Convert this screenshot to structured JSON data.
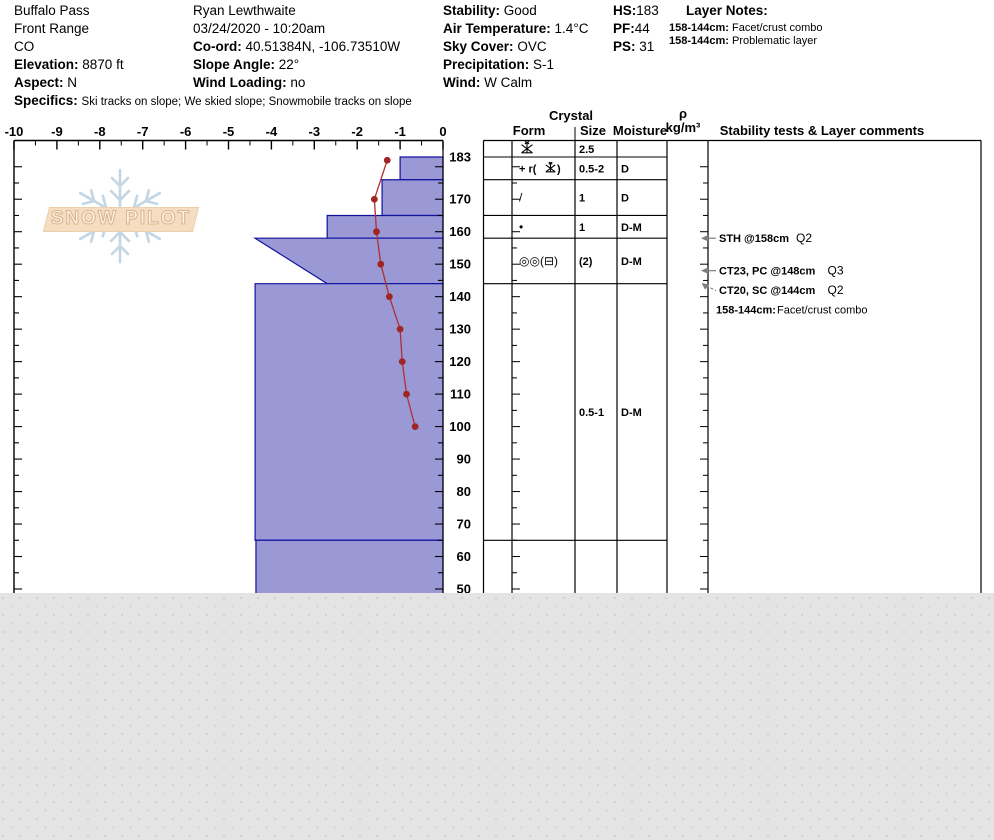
{
  "header": {
    "location": {
      "line1": "Buffalo Pass",
      "line2": "Front Range",
      "line3": "CO",
      "elevation_label": "Elevation:",
      "elevation": "8870 ft",
      "aspect_label": "Aspect:",
      "aspect": "N",
      "specifics_label": "Specifics:",
      "specifics": "Ski tracks on slope; We skied slope; Snowmobile tracks on slope"
    },
    "observer": {
      "name": "Ryan Lewthwaite",
      "datetime": "03/24/2020 - 10:20am",
      "coord_label": "Co-ord:",
      "coord": "40.51384N, -106.73510W",
      "slope_angle_label": "Slope Angle:",
      "slope_angle": "22°",
      "wind_loading_label": "Wind Loading:",
      "wind_loading": "no"
    },
    "conditions": {
      "stability_label": "Stability:",
      "stability": "Good",
      "air_temp_label": "Air Temperature:",
      "air_temp": "1.4°C",
      "sky_label": "Sky Cover:",
      "sky": "OVC",
      "precip_label": "Precipitation:",
      "precip": "S-1",
      "wind_label": "Wind:",
      "wind": "W Calm"
    },
    "summary": {
      "hs_label": "HS:",
      "hs": "183",
      "pf_label": "PF:",
      "pf": "44",
      "ps_label": "PS:",
      "ps": " 31"
    },
    "layer_notes": {
      "title": "Layer Notes:",
      "notes": [
        {
          "range": "158-144cm:",
          "text": "Facet/crust combo"
        },
        {
          "range": "158-144cm:",
          "text": "Problematic layer"
        }
      ]
    }
  },
  "logo": {
    "text": "SNOW PILOT"
  },
  "table": {
    "crystal_header": "Crystal",
    "form_header": "Form",
    "size_header": "Size",
    "moisture_header": "Moisture",
    "rho_header": "ρ",
    "rho_unit": "kg/m³",
    "comments_header": "Stability tests & Layer comments"
  },
  "chart_data": {
    "type": "snow-profile",
    "temp_axis": {
      "min": -10,
      "max": 0,
      "unit": "°C",
      "tick_labels": [
        "-10",
        "-9",
        "-8",
        "-7",
        "-6",
        "-5",
        "-4",
        "-3",
        "-2",
        "-1",
        "0"
      ]
    },
    "depth_axis": {
      "unit": "cm",
      "surface": 183,
      "labels": [
        183,
        170,
        160,
        150,
        140,
        130,
        120,
        110,
        100,
        90,
        80,
        70,
        60,
        50
      ]
    },
    "temperature_profile": [
      {
        "depth": 182,
        "temp": -1.3
      },
      {
        "depth": 170,
        "temp": -1.6
      },
      {
        "depth": 160,
        "temp": -1.55
      },
      {
        "depth": 150,
        "temp": -1.45
      },
      {
        "depth": 140,
        "temp": -1.25
      },
      {
        "depth": 130,
        "temp": -1.0
      },
      {
        "depth": 120,
        "temp": -0.95
      },
      {
        "depth": 110,
        "temp": -0.85
      },
      {
        "depth": 100,
        "temp": -0.65
      }
    ],
    "surface_grains": {
      "form_type": "stellar",
      "size": "2.5",
      "moisture": ""
    },
    "layers": [
      {
        "top": 183,
        "bottom": 176,
        "hardness_top": 1.0,
        "hardness_bottom": 1.0,
        "form_type": "composite",
        "form_before": "+ r(",
        "form_after": ")",
        "size": "0.5-2",
        "moisture": "D"
      },
      {
        "top": 176,
        "bottom": 165,
        "hardness_top": 1.42,
        "hardness_bottom": 1.42,
        "form_type": "text",
        "form": "/",
        "size": "1",
        "moisture": "D"
      },
      {
        "top": 165,
        "bottom": 158,
        "hardness_top": 2.7,
        "hardness_bottom": 2.7,
        "form_type": "text",
        "form": "•",
        "size": "1",
        "moisture": "D-M"
      },
      {
        "top": 158,
        "bottom": 144,
        "hardness_top": 4.38,
        "hardness_bottom": 2.7,
        "form_type": "text",
        "form": "◎◎(⊟)",
        "size": "(2)",
        "moisture": "D-M"
      },
      {
        "top": 144,
        "bottom": 65,
        "hardness_top": 4.38,
        "hardness_bottom": 4.38,
        "form_type": "none",
        "form": "",
        "size": "0.5-1",
        "moisture": "D-M"
      },
      {
        "top": 65,
        "bottom": 47,
        "hardness_top": 4.36,
        "hardness_bottom": 4.36,
        "form_type": "none",
        "form": "",
        "size": "",
        "moisture": ""
      }
    ],
    "stability_tests": [
      {
        "label": "STH @158cm",
        "score": "Q2",
        "depth": 158,
        "dashed": false
      },
      {
        "label": "CT23, PC @148cm",
        "score": "Q3",
        "depth": 148,
        "dashed": false
      },
      {
        "label": "CT20, SC @144cm",
        "score": "Q2",
        "depth": 144,
        "dashed": true
      }
    ],
    "layer_comments": [
      {
        "range": "158-144cm:",
        "text": "Facet/crust combo",
        "depth": 136
      }
    ]
  },
  "colors": {
    "layer_fill": "#9a99d5",
    "layer_border": "#1212a0",
    "temp_line": "#b03030",
    "temp_dot": "#a02626",
    "arrow": "#7d7d7d",
    "grid": "#000000",
    "logo_flake": "#c3d6e3",
    "logo_banner_fill": "#f5ddc2",
    "logo_banner_border": "#eccfab",
    "logo_text": "#fbf3e6"
  }
}
